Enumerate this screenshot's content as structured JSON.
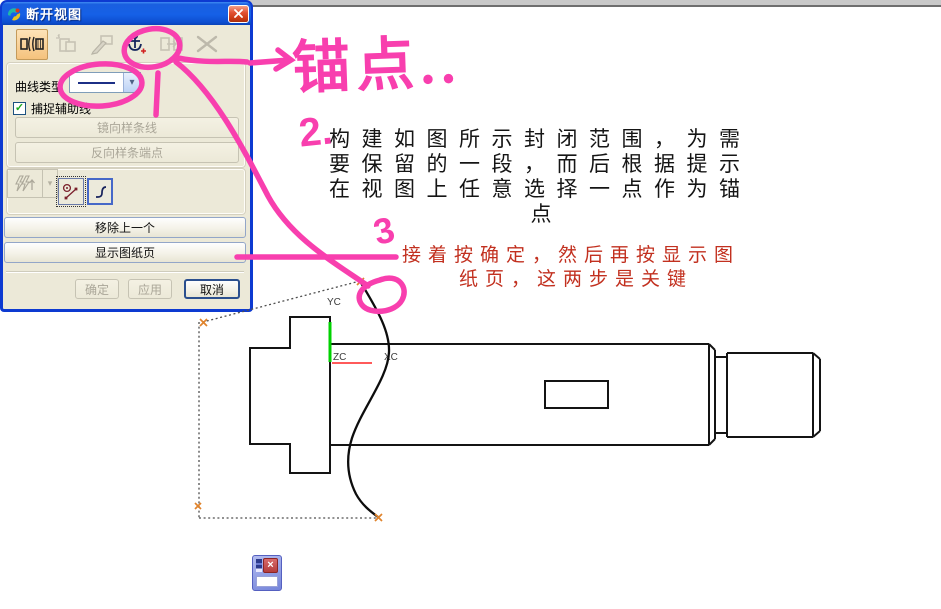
{
  "dialog": {
    "title": "断开视图",
    "curve_type_label": "曲线类型",
    "curve_type_value": "solid-line",
    "snap_helper_label": "捕捉辅助线",
    "snap_helper_checked": true,
    "mirror_spline_label": "镜向样条线",
    "reverse_spline_label": "反向样条端点",
    "remove_last_label": "移除上一个",
    "show_sheet_label": "显示图纸页",
    "ok_label": "确定",
    "apply_label": "应用",
    "cancel_label": "取消"
  },
  "annotations": {
    "pink_color": "#f83fae",
    "handwritten_anchor": "锚点..",
    "handwritten_step2": "2.",
    "handwritten_step3": "3",
    "note_black_lines": [
      "构建如图所示封闭范围，为需",
      "要保留的一段，而后根据提示",
      "在视图上任意选择一点作为锚",
      "点"
    ],
    "note_red_lines": [
      "接着按确定，然后再按显示图",
      "纸页，这两步是关键"
    ]
  },
  "drawing": {
    "axis_labels": {
      "yc": "YC",
      "zc": "ZC",
      "xc": "XC"
    },
    "y_axis_color": "#00d200",
    "x_axis_color": "#ff5a5a"
  },
  "icons": {
    "checkmark": "✓",
    "dropdown_arrow": "▾"
  }
}
